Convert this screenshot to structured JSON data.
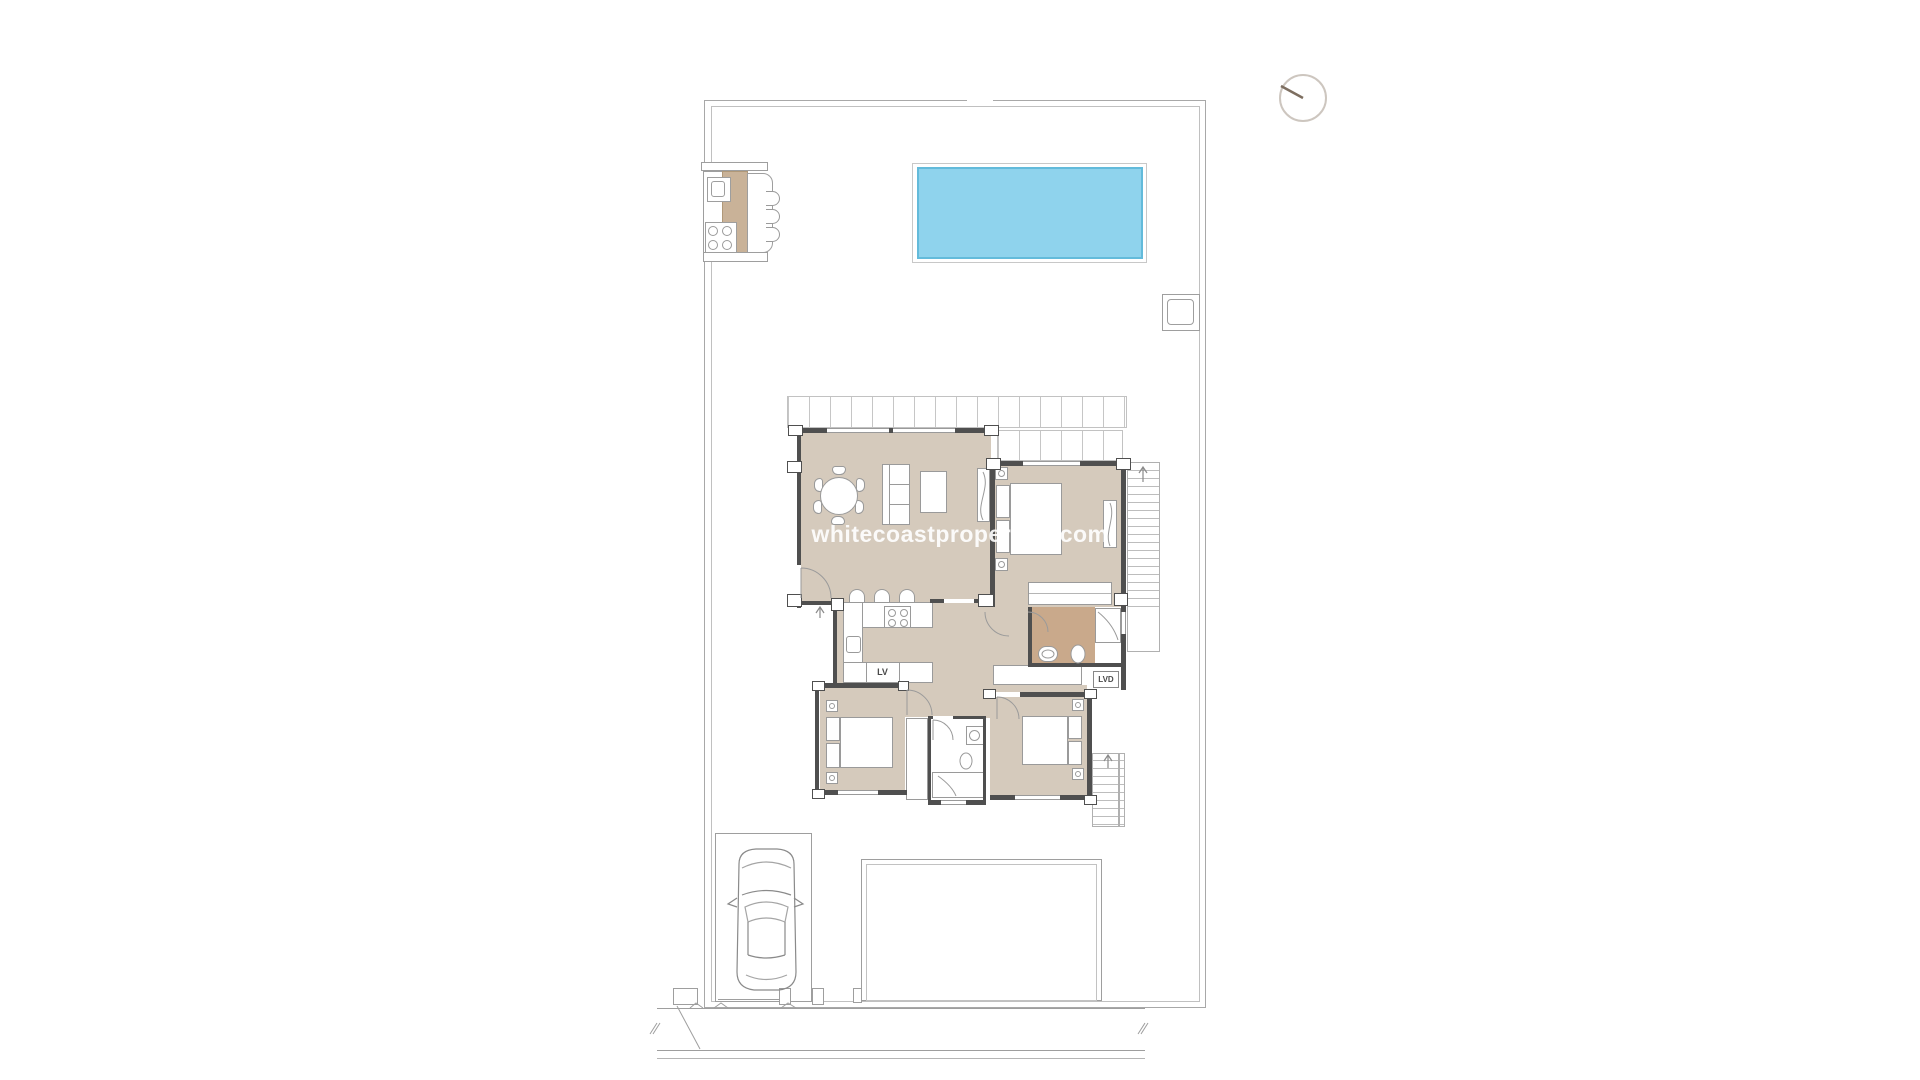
{
  "watermark": {
    "text": "whitecoastproperties.com"
  },
  "labels": {
    "dishwasher_abbr": "LV",
    "laundry_abbr": "LVD"
  },
  "colors": {
    "pool_fill": "#8fd3ed",
    "pool_edge": "#63bbdb",
    "floor_beige": "#d5cabc",
    "floor_tan": "#c9a98b",
    "counter_tan": "#c9b298",
    "wall_dark": "#4f4f4f",
    "line_gray": "#9e9e9e",
    "boundary_gray": "#a8a8a8",
    "watermark_white": "rgba(255,255,255,0.9)"
  }
}
